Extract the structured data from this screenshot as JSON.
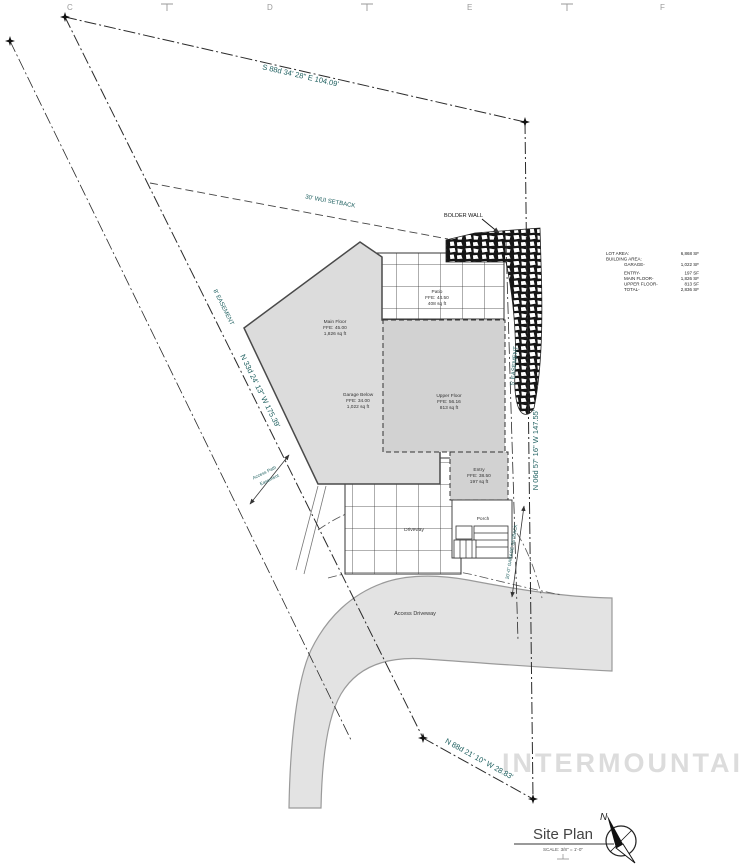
{
  "drawing": {
    "title": "Site Plan",
    "scale_note": "SCALE: 3/8\" = 1'-0\"",
    "north_label": "N",
    "watermark": "INTERMOUNTAIN"
  },
  "grid_letters": [
    "C",
    "D",
    "E",
    "F"
  ],
  "survey": {
    "north_bearing": "S 88d 34' 28\" E 104.09'",
    "west_bearing": "N 33d 24' 13\" W 175.39'",
    "east_bearing": "N 06d 57' 16\" W 147.55'",
    "south_bearing": "N 88d 21' 10\" W 28.83'",
    "west_easement": "8' EASEMENT",
    "east_easement": "5' EASEMENT",
    "wui_setback": "30' WUI SETBACK",
    "garage_setback": "20'-0\" GARAGE SETBACK",
    "access_path": [
      "Access Path",
      "Easement"
    ]
  },
  "labels": {
    "bolder_wall": "BOLDER WALL",
    "main_floor": [
      "Main Floor",
      "FFE: 45.00",
      "1,826 sq ft"
    ],
    "garage": [
      "Garage Below",
      "FFE: 34.00",
      "1,022 sq ft"
    ],
    "upper_floor": [
      "Upper Floor",
      "FFE: 56.16",
      "813 sq ft"
    ],
    "patio": [
      "Patio",
      "FFE: 44.50",
      "408 sq ft"
    ],
    "entry": [
      "Entry",
      "FFE: 38.50",
      "197 sq ft"
    ],
    "porch": "Porch",
    "driveway": "Driveway",
    "access_driveway": "Access Driveway"
  },
  "area_table": {
    "rows": [
      {
        "label": "LOT AREA:",
        "value": "6,868 SF"
      },
      {
        "label": "BUILDING AREA:",
        "value": ""
      },
      {
        "label": "GARAGE-",
        "value": "1,022 SF"
      },
      {
        "label": "ENTRY-",
        "value": "197 SF"
      },
      {
        "label": "MAIN FLOOR-",
        "value": "1,826 SF"
      },
      {
        "label": "UPPER FLOOR-",
        "value": "813 SF"
      },
      {
        "label": "TOTAL-",
        "value": "2,836 SF"
      }
    ]
  },
  "colors": {
    "survey_text": "#1f6060",
    "building_fill": "#dcdcdc",
    "upper_fill": "#d2d2d2",
    "driveway_fill": "#e3e3e3",
    "watermark": "#dcdcdc",
    "line": "#333333"
  }
}
